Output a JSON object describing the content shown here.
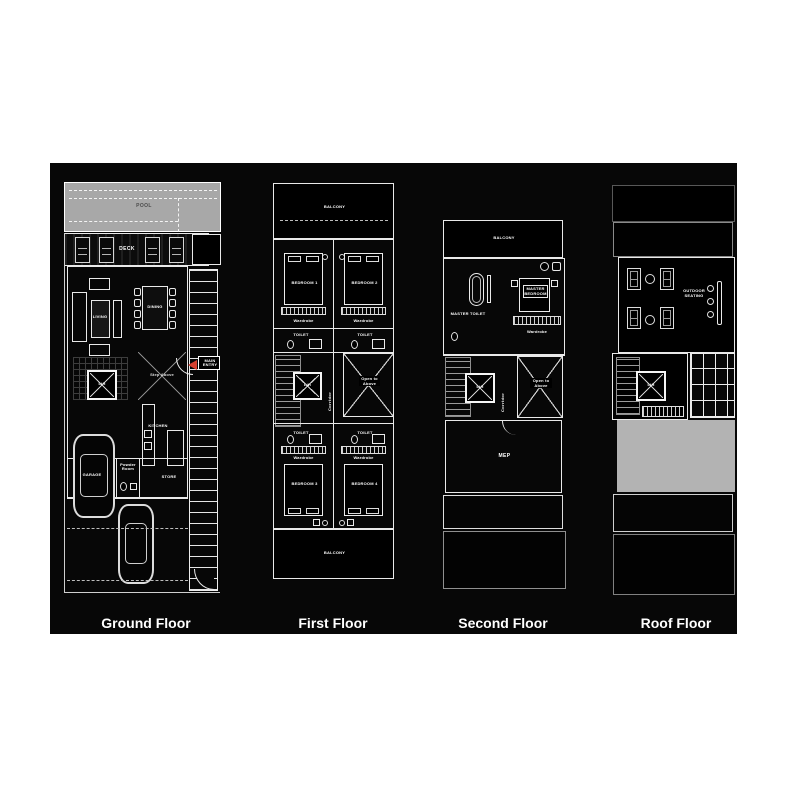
{
  "palette": {
    "page_bg": "#ffffff",
    "canvas_bg": "#070707",
    "line_white": "#ececec",
    "pool_gray": "#a8a8a8",
    "roof_gray": "#b3b3b3",
    "entry_arrow_red": "#d6402f"
  },
  "floors": {
    "ground": {
      "label": "Ground Floor",
      "pool": "POOL",
      "deck": "DECK",
      "living": "LIVING",
      "dining": "DINING",
      "step_above": "Step Above",
      "main_entry": "MAIN ENTRY",
      "lift": "Lift",
      "kitchen": "KITCHEN",
      "garage": "GARAGE",
      "powder_room": "Powder Room",
      "store": "STORE"
    },
    "first": {
      "label": "First Floor",
      "balcony": "BALCONY",
      "bedroom1": "BEDROOM 1",
      "bedroom2": "BEDROOM 2",
      "bedroom3": "BEDROOM 3",
      "bedroom4": "BEDROOM 4",
      "wardrobe": "Wardrobe",
      "toilet": "TOILET",
      "corridor": "Corridor",
      "lift": "Lift",
      "open_void": "Open to Above"
    },
    "second": {
      "label": "Second Floor",
      "balcony": "BALCONY",
      "master_toilet": "MASTER TOILET",
      "master_bedroom": "MASTER BEDROOM",
      "wardrobe": "Wardrobe",
      "corridor": "Corridor",
      "lift": "Lift",
      "open_void": "Open to Above",
      "mep": "MEP"
    },
    "roof": {
      "label": "Roof Floor",
      "outdoor_seating": "OUTDOOR SEATING",
      "lift": "Lift"
    }
  }
}
